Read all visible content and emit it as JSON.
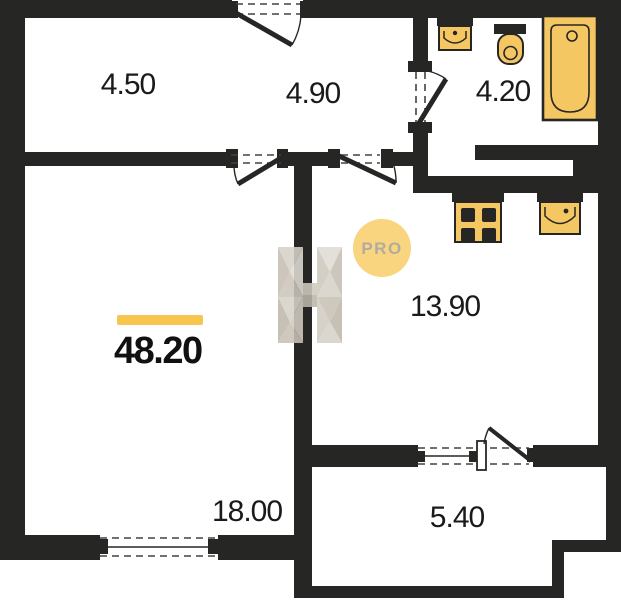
{
  "plan": {
    "rooms": [
      {
        "name": "storage",
        "label": "4.50"
      },
      {
        "name": "hallway",
        "label": "4.90"
      },
      {
        "name": "bathroom",
        "label": "4.20"
      },
      {
        "name": "kitchen",
        "label": "13.90"
      },
      {
        "name": "living-room",
        "label": "18.00"
      },
      {
        "name": "balcony",
        "label": "5.40"
      }
    ],
    "total_area": "48.20",
    "badge": "PRO",
    "colors": {
      "wall": "#262624",
      "fixture_fill": "#f5c763",
      "fixture_outline": "#262624",
      "accent_bar": "#f7c64e",
      "badge_bg": "#f8d57e",
      "badge_text": "#b2aba0",
      "label_text": "#1a1a1a",
      "watermark_light": "#ddd9d1",
      "watermark_dark": "#b5ada0"
    }
  }
}
